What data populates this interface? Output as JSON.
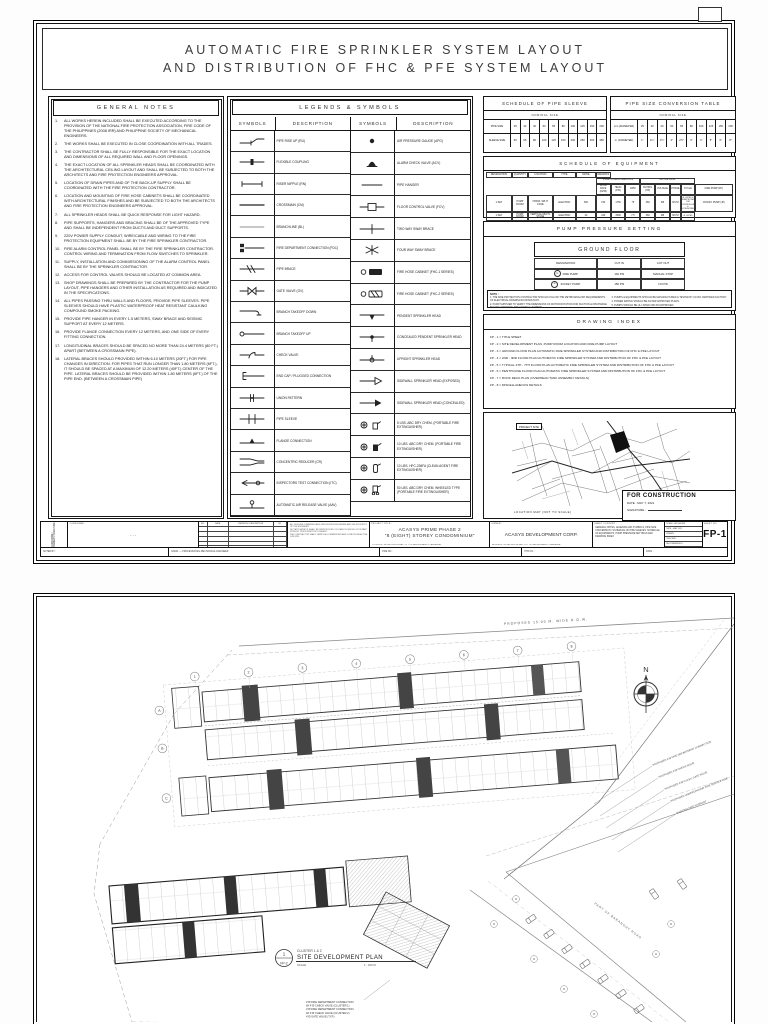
{
  "doc": {
    "title_line1": "AUTOMATIC  FIRE  SPRINKLER  SYSTEM  LAYOUT",
    "title_line2": "AND  DISTRIBUTION  OF  FHC  &  PFE  SYSTEM  LAYOUT"
  },
  "general_notes": {
    "title": "GENERAL NOTES",
    "items": [
      "ALL WORKS HEREIN INCLUDED SHALL BE EXECUTED ACCORDING TO THE PROVISION OF THE NATIONAL FIRE PROTECTION ASSOCIATION, FIRE CODE OF THE PHILIPPINES (2008 IRR) AND PHILIPPINE SOCIETY OF MECHANICAL ENGINEERS.",
      "THE WORKS SHALL BE EXECUTED IN CLOSE COORDINATION WITH ALL TRADES.",
      "THE CONTRACTOR SHALL BE FULLY RESPONSIBLE FOR THE EXACT LOCATION AND DIMENSIONS OF ALL REQUIRED WALL AND FLOOR OPENINGS.",
      "THE EXACT LOCATION OF ALL SPRINKLER HEADS SHALL BE COORDINATED WITH THE ARCHITECTURAL CEILING LAYOUT AND SHALL BE SUBJECTED TO BOTH THE ARCHITECTS AND FIRE PROTECTION ENGINEERS APPROVAL.",
      "LOCATION OF DRAIN PIPES AND OF THE BACK-UP SUPPLY SHALL BE COORDINATED WITH THE FIRE PROTECTION CONTRACTOR.",
      "LOCATION AND MOUNTING OF FIRE HOSE CABINETS SHALL BE COORDINATED WITH ARCHITECTURAL FINISHES AND BE SUBJECTED TO BOTH THE ARCHITECTS AND FIRE PROTECTION ENGINEERS APPROVAL.",
      "ALL SPRINKLER HEADS SHALL BE QUICK RESPONSE FOR LIGHT HAZARD.",
      "PIPE SUPPORTS, HANGERS AND BRACING SHALL BE OF THE APPROVED TYPE AND SHALL BE INDEPENDENT FROM DUCTS AND DUCT SUPPORTS.",
      "220V POWER SUPPLY CONDUIT, WIRE/CABLE AND WIRING TO THE FIRE PROTECTION EQUIPMENT SHALL BE BY THE FIRE SPRINKLER CONTRACTOR.",
      "FIRE ALARM CONTROL PANEL SHALL BE BY THE FIRE SPRINKLER CONTRACTOR. CONTROL WIRING AND TERMINATION FROM FLOW SWITCHES TO SPRINKLER.",
      "SUPPLY, INSTALLATION AND COMMISSIONING OF THE ALARM CONTROL PANEL SHALL BE BY THE SPRINKLER CONTRACTOR.",
      "ACCESS FOR CONTROL VALVES SHOULD BE LOCATED AT COMMON AREA.",
      "SHOP DRAWINGS SHALL BE PREPARED BY THE CONTRACTOR FOR THE PUMP LAYOUT, PIPE HANGERS AND OTHER INSTALLATION AS REQUIRED AND INDICATED IN THE SPECIFICATIONS.",
      "ALL PIPES PASSING THRU WALLS AND FLOORS, PROVIDE PIPE SLEEVES. PIPE SLEEVES SHOULD HAVE PLASTIC WATERPROOF HEAT RESISTANT CAULKING COMPOUND SMOKE PACKING.",
      "PROVIDE PIPE HANGER IN EVERY 1.5 METERS, SWAY BRACE AND SEISMIC SUPPORT AT EVERY 12 METERS.",
      "PROVIDE FLANGE CONNECTION EVERY 12 METERS, AND ONE SIDE OF EVERY FITTING CONNECTION.",
      "LONGITUDINAL BRACES SHOULD BE SPACED NO MORE THAN 24.4 METERS (80 FT.) APART (BETWEEN A CROSSMAIN PIPE).",
      "LATERAL BRACES SHOULD PROVIDED WITHIN 6.10 METERS (20FT.) FOR PIPE CHANGES IN DIRECTION. FOR PIPES THAT RUN LONGER THAN 1.80 METERS (6FT.), IT SHOULD BE SPACED AT A MAXIMUM OF 12.20 METERS (40FT.) CENTER OF THE PIPE. LATERAL BRACES SHOULD BE PROVIDED WITHIN 1.80 METERS (6FT.) OF THE PIPE END. (BETWEEN A CROSSMAIN PIPE)"
    ]
  },
  "legends": {
    "title": "LEGENDS & SYMBOLS",
    "col_symbols": "SYMBOLS",
    "col_description": "DESCRIPTION",
    "left": [
      "PIPE RISE UP (RU)",
      "FLEXIBLE COUPLING",
      "RISER NIPPLE (RN)",
      "CROSSMAIN (CM)",
      "BRANCHLINE (BL)",
      "FIRE DEPARTMENT CONNECTION (FDC)",
      "PIPE BRACE",
      "GATE VALVE (GV)",
      "BRANCH TAKEOFF DOWN",
      "BRANCH TAKEOFF UP",
      "CHECK VALVE",
      "END CAP / PLUGGED CONNECTION",
      "UNION PATTERN",
      "PIPE SLEEVE",
      "FLANGE CONNECTION",
      "CONCENTRIC REDUCER (CR)",
      "INSPECTORS TEST CONNECTION (ITC)",
      "AUTOMATIC AIR RELEASE VALVE (AAV)"
    ],
    "right": [
      "AIR PRESSURE GAUGE (APG)",
      "ALARM CHECK VALVE (ACV)",
      "PIPE HANGER",
      "FLOOR CONTROL VALVE (FCV)",
      "TWO WAY SWAY BRACE",
      "FOUR WAY SWAY BRACE",
      "FIRE HOSE CABINET (FHC-1 SERIES)",
      "FIRE HOSE CABINET (FHC-2 SERIES)",
      "PENDENT SPRINKLER HEAD",
      "CONCEALED PENDENT SPRINKLER HEAD",
      "UPRIGHT SPRINKLER HEAD",
      "SIDEWALL SPRINKLER HEAD (EXPOSED)",
      "SIDEWALL SPRINKLER HEAD (CONCEALED)",
      "5 LBS. ABC DRY CHEM. (PORTABLE FIRE EXTINGUISHER)",
      "10 LBS. ABC DRY CHEM. (PORTABLE FIRE EXTINGUISHER)",
      "10 LBS. HFC-236FA (CLEAN AGENT FIRE EXTINGUISHER)",
      "50 LBS. ABC DRY CHEM. WHEELED TYPE (PORTABLE FIRE EXTINGUISHER)"
    ]
  },
  "pipe_sleeve": {
    "title": "SCHEDULE OF PIPE SLEEVE",
    "subheader": "NOMINAL SIZE",
    "row1_label": "PIPE SIZE",
    "row1": [
      "25",
      "32",
      "40",
      "50",
      "65",
      "80",
      "100",
      "125",
      "150",
      "200"
    ],
    "row2_label": "SLEEVE SIZE",
    "row2": [
      "50",
      "65",
      "80",
      "100",
      "125",
      "150",
      "200",
      "250",
      "300",
      "350"
    ]
  },
  "conversion": {
    "title": "PIPE SIZE CONVERSION TABLE",
    "subheader": "NOMINAL SIZE",
    "row1_label": "mm (DIAMETER)",
    "row1": [
      "25",
      "32",
      "40",
      "50",
      "65",
      "80",
      "100",
      "125",
      "150",
      "200"
    ],
    "row2_label": "in. (DIAMETER)",
    "row2": [
      "1\"",
      "1¼\"",
      "1½\"",
      "2\"",
      "2½\"",
      "3\"",
      "4\"",
      "5\"",
      "6\"",
      "8\""
    ]
  },
  "equipment": {
    "title": "SCHEDULE OF EQUIPMENT",
    "h_designation": "DESIGNATION",
    "h_quantity": "QUANTITY",
    "h_location": "LOCATION",
    "h_type": "TYPE",
    "h_drive": "DRIVE",
    "h_pump_group": "PUMP CHARACTERISTICS",
    "h_motor_group": "MOTOR DATA",
    "h_flow": "FLOW RATE (GPM)",
    "h_head": "HEAD (PSI)",
    "h_rpm": "RPM",
    "h_rating": "RATING (HP)",
    "h_voltage": "VOLTAGE",
    "h_phase": "PHASE",
    "h_cycle": "CYCLE",
    "h_remarks": "REMARKS",
    "rows": [
      [
        "FIRE PUMP (FP)",
        "1 SET",
        "PUMP ROOM",
        "HORIZ. SPLIT CASE",
        "ELECTRIC",
        "500",
        "150",
        "1750",
        "75",
        "460",
        "3Ø",
        "60 HZ",
        "UL LISTED & FM APPROVED C/W CONTROLLER & ACCESSORIES"
      ],
      [
        "JOCKEY PUMP (JP)",
        "1 SET",
        "PUMP ROOM",
        "VERTICAL MULTI-STAGE",
        "ELECTRIC",
        "40",
        "160",
        "3500",
        "7.5",
        "460",
        "3Ø",
        "60 HZ",
        "UL LISTED"
      ]
    ]
  },
  "pump_pressure": {
    "title": "PUMP PRESSURE SETTING",
    "floor": "GROUND FLOOR",
    "cols": [
      "DESIGNATION",
      "CUT IN",
      "CUT OUT"
    ],
    "rows": [
      {
        "tag": "FP",
        "name": "FIRE PUMP",
        "cut_in": "140 PSI",
        "cut_out": "MANUAL STOP"
      },
      {
        "tag": "JP",
        "name": "JOCKEY PUMP",
        "cut_in": "150 PSI",
        "cut_out": "170 PSI"
      }
    ],
    "note_label": "NOTE :",
    "notes_left": [
      "1.  THE FIRE PROTECTION CONTRACTOR SHOULD FOLLOW THE METRIC/ENGLISH REQUIREMENTS OF ELECTRICAL DRAWINGS/CONSULTANT.",
      "2.  PUMP SUPPLIER TO VERIFY THE DIMENSIONS OF MOTOR ROTATION FOR SUCTION & DISCHARGE BEFORE ORDERING THE VERTICAL TURBINE."
    ],
    "notes_right": [
      "3.  PUMPS & EQUIPMENTS SHOULD BE MANUFACTURED & TESTED BY AN ISO CERTIFIED FACTORY.",
      "4.  POWER RATING SHOULD BE AS PER APPROVED PLANS.",
      "5.  PUMPS SHOULD BE UL LISTED AND FM APPROVED."
    ]
  },
  "drawing_index": {
    "title": "DRAWING INDEX",
    "items": [
      "FP - 1  =  TITLE SHEET",
      "FP - 2  =  SITE DEVELOPMENT PLAN, PUMP ROOM LOCATION AND FIRE PUMP LAYOUT",
      "FP - 3  =  GROUND FLOOR PLAN AUTOMATIC FIRE SPRINKLER SYSTEM AND DISTRIBUTION OF FHC & PFE LAYOUT",
      "FP - 4  =  2ND - 3RD FLOOR PLAN AUTOMATIC FIRE SPRINKLER SYSTEM AND DISTRIBUTION OF FHC & PFE LAYOUT",
      "FP - 5  =  TYPICAL 4TH - 7TH FLOOR PLAN AUTOMATIC FIRE SPRINKLER SYSTEM AND DISTRIBUTION OF FHC & PFE LAYOUT",
      "FP - 6  =  PENTHOUSE FLOOR PLAN AUTOMATIC FIRE SPRINKLER SYSTEM AND DISTRIBUTION OF FHC & PFE LAYOUT",
      "FP - 7  =  ROOF DECK PLAN (OVERHEAD TANK ASSEMBLY DETAILS)",
      "FP - 8  =  MISCELLANEOUS DETAILS"
    ]
  },
  "map": {
    "site_label": "PROJECT SITE",
    "caption": "LOCATION MAP (NOT TO SCALE)"
  },
  "stamp": {
    "line1": "FOR CONSTRUCTION",
    "line2": "DATE : MAY 7, 2021",
    "line3": "SIGNATURE :"
  },
  "title_block": {
    "conforme_vert": "CONFORME / OWNER'S SIGNATURE",
    "conforme_label": "CONFORME :",
    "sign_dots": ". . .",
    "rev_headers": [
      "NO.",
      "DATE",
      "REVISION / DESCRIPTION",
      "BY"
    ],
    "approval_lines": [
      "ALL DESIGNS, DRAWINGS AND SPECIFICATIONS HEREIN ARE THE PROPERTY OF THE ENGINEER.",
      "NO PART HEREOF SHALL BE REPRODUCED OR USED IN WHOLE OR IN PART WITHOUT PRIOR WRITTEN CONSENT.",
      "THE CONTRACTOR SHALL VERIFY ALL DIMENSIONS AND CONDITIONS AT THE JOB SITE."
    ],
    "project_label": "PROJECT TITLE :",
    "project_line1": "ACASYS PRIME  PHASE 2",
    "project_line2": "\"8 (EIGHT) STOREY CONDOMINIUM\"",
    "project_sub": "LOCATION : MC ARTHUR HI-WAY, CITY OF SAN FERNANDO, PAMPANGA",
    "owner_label": "OWNER :",
    "owner": "ACASYS DEVELOPMENT CORP.",
    "owner_sub": "ADDRESS : MC ARTHUR HI-WAY, CITY OF SAN FERNANDO, PAMPANGA",
    "content_label": "SHEET CONTENT :",
    "content": "GENERAL NOTES, LEGENDS AND SYMBOLS, PIPE SIZE CONVERSION / SCHEDULE OF PIPE SLEEVES, SCHEDULE OF EQUIPMENTS, PUMP PRESSURE SETTINGS AND DRAWING INDEX",
    "meta_rows": [
      "SCALE : AS SHOWN",
      "DATE : MAY 2021",
      "DRAWN :",
      "CHECKED :",
      "RECOMMENDED :",
      "APPROVED :"
    ],
    "sheet_label": "SHEET NO.",
    "sheet_no": "FP-1",
    "band_labels": [
      "NOTED BY :",
      "ENGR. — PROFESSIONAL MECHANICAL ENGINEER",
      "PME NO. :",
      "PTR NO. :",
      "DATE :"
    ]
  },
  "site_plan": {
    "north": "N",
    "road_top": "PROPOSED 15.00 M. WIDE R.O.W.",
    "road_right": "PART OF BARANGAY ROAD",
    "grid_numbers": [
      "1",
      "2",
      "3",
      "4",
      "5",
      "6",
      "7",
      "8"
    ],
    "grid_letters": [
      "A",
      "B",
      "C"
    ],
    "leaders": [
      "PROPOSED 4\"Ø FIRE DEPARTMENT CONNECTION",
      "PROPOSED 4\"Ø CHECK VALVE",
      "PROPOSED 4\"Ø O.S.&Y. GATE VALVE",
      "PROPOSED UNDERGROUND FIRE SERVICE LINE",
      "EXISTING FIRE HYDRANT"
    ],
    "annotation": [
      "4\"Ø FIRE DEPARTMENT CONNECTION",
      "W/ 4\"Ø CHECK VALVE (CLUSTER 1)",
      "4\"Ø FIRE DEPARTMENT CONNECTION",
      "W/ 4\"Ø CHECK VALVE (CLUSTER 2)",
      "4\"Ø GATE VALVE (TYP.)"
    ],
    "caption": {
      "bubble_top": "1",
      "bubble_bottom": "FP-2",
      "cluster": "CLUSTER 1 & 2",
      "title": "SITE DEVELOPMENT PLAN",
      "scale_label": "SCALE",
      "scale_value": "1 : 400 M."
    }
  }
}
